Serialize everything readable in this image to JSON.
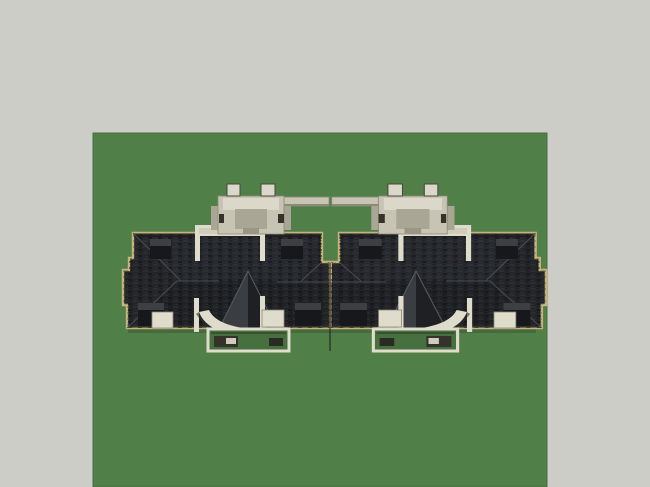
{
  "app": {
    "type": "3d-model-viewport",
    "view": "aerial-top",
    "description": "Twin attached residential buildings with dark hip roofs on a green ground plane"
  },
  "scene": {
    "colors": {
      "background": "#cccdc7",
      "grass": "#507f48",
      "grass_shadow": "#3a5a36",
      "patio_grass": "#47703f",
      "trim": "#c6b47c",
      "roof": "#232529",
      "roof_upper_sheen": "#2c2e33",
      "roof_lower_shade": "#1c1e21",
      "hip_highlight": "#4e5156",
      "pyramid_light": "#3a3d42",
      "pyramid_dark": "#1e2024",
      "pyramid_edge": "#575a5f",
      "cream": "#e0dccb",
      "cream_mid": "#cfccbc",
      "cream_shadow": "#9a9687",
      "beige": "#c8c4b4",
      "beige_light": "#dbd7c9",
      "beige_mid": "#aaa695",
      "beige_dark": "#8e8a7a",
      "dark_accent": "#33322b",
      "chimney_body": "#17181b",
      "chimney_cap": "#3d3f42",
      "seam": "#17181a"
    },
    "ground": {
      "name": "grass-ground-plane"
    },
    "buildings": [
      {
        "name": "building-left",
        "components": [
          "hip-roof",
          "roof-deck",
          "rooftop-access-structure",
          "chimneys",
          "bow-roof-pyramid",
          "bow-balcony",
          "ground-patio"
        ]
      },
      {
        "name": "building-right",
        "mirrored": true,
        "components": [
          "hip-roof",
          "roof-deck",
          "rooftop-access-structure",
          "chimneys",
          "bow-roof-pyramid",
          "bow-balcony",
          "ground-patio"
        ]
      }
    ]
  }
}
